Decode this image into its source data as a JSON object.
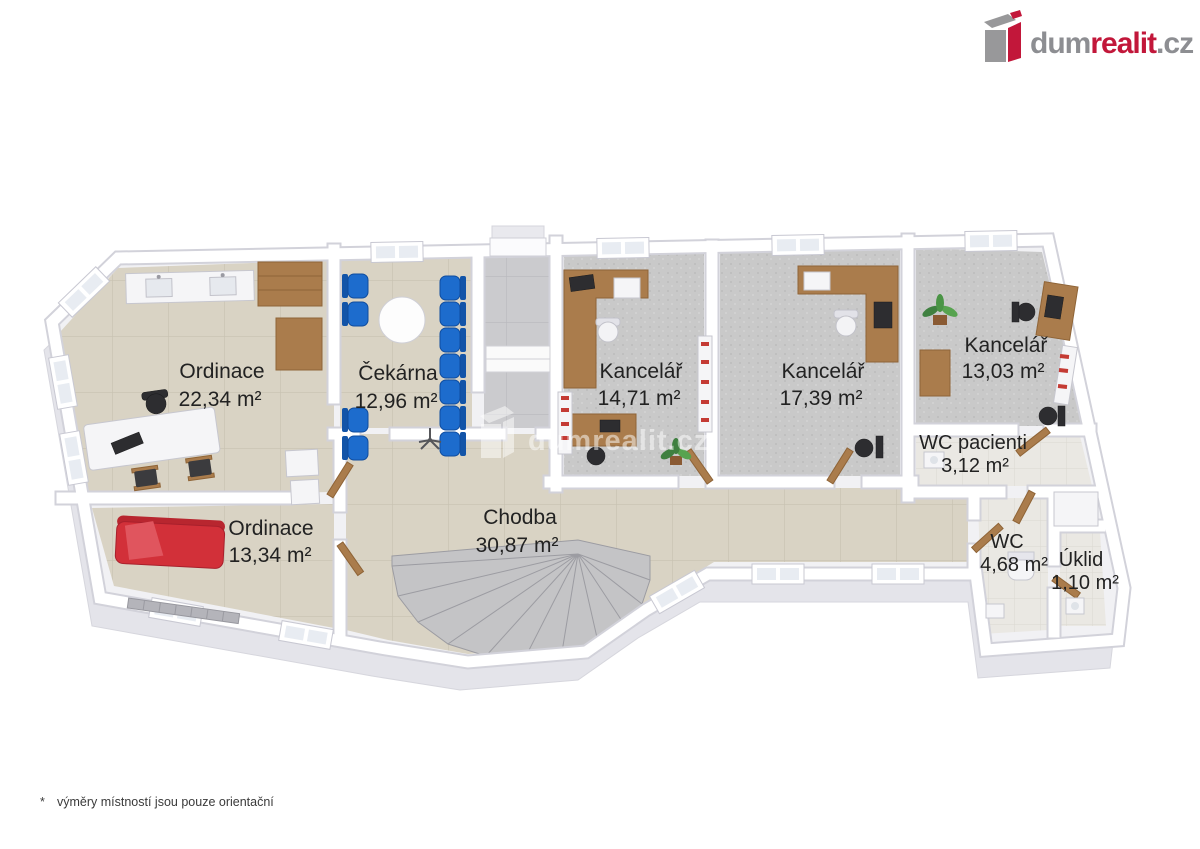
{
  "page": {
    "background": "#ffffff"
  },
  "logo": {
    "prefix": "dum",
    "accent": "realit",
    "suffix": ".cz",
    "icon": "dumrealit-box-icon",
    "colors": {
      "gray": "#8d8e92",
      "red": "#c2173a"
    }
  },
  "watermark": {
    "text": "dumrealit.cz",
    "icon": "dumrealit-box-icon"
  },
  "footnote": {
    "marker": "*",
    "text": "výměry místností jsou pouze orientační"
  },
  "floorplan": {
    "rooms": [
      {
        "id": "ordinace-1",
        "name": "Ordinace",
        "area": "22,34 m²",
        "floor": "tile-beige"
      },
      {
        "id": "cekarna",
        "name": "Čekárna",
        "area": "12,96 m²",
        "floor": "tile-beige"
      },
      {
        "id": "ordinace-2",
        "name": "Ordinace",
        "area": "13,34 m²",
        "floor": "tile-beige"
      },
      {
        "id": "chodba",
        "name": "Chodba",
        "area": "30,87 m²",
        "floor": "tile-beige"
      },
      {
        "id": "kancelar-1",
        "name": "Kancelář",
        "area": "14,71 m²",
        "floor": "carpet-gray"
      },
      {
        "id": "kancelar-2",
        "name": "Kancelář",
        "area": "17,39 m²",
        "floor": "carpet-gray"
      },
      {
        "id": "kancelar-3",
        "name": "Kancelář",
        "area": "13,03 m²",
        "floor": "carpet-gray"
      },
      {
        "id": "wc-pacienti",
        "name": "WC pacienti",
        "area": "3,12 m²",
        "floor": "tile-white"
      },
      {
        "id": "wc",
        "name": "WC",
        "area": "4,68 m²",
        "floor": "tile-white"
      },
      {
        "id": "uklid",
        "name": "Úklid",
        "area": "1,10 m²",
        "floor": "tile-white"
      }
    ],
    "colors": {
      "floor_tile": "#d9d3c4",
      "carpet": "#c9c9c9",
      "wood": "#aa7c4c",
      "chair_blue": "#1d6ccd",
      "couch_red": "#d23039",
      "wall": "#ffffff",
      "stairs": "#c4c4c6"
    }
  }
}
